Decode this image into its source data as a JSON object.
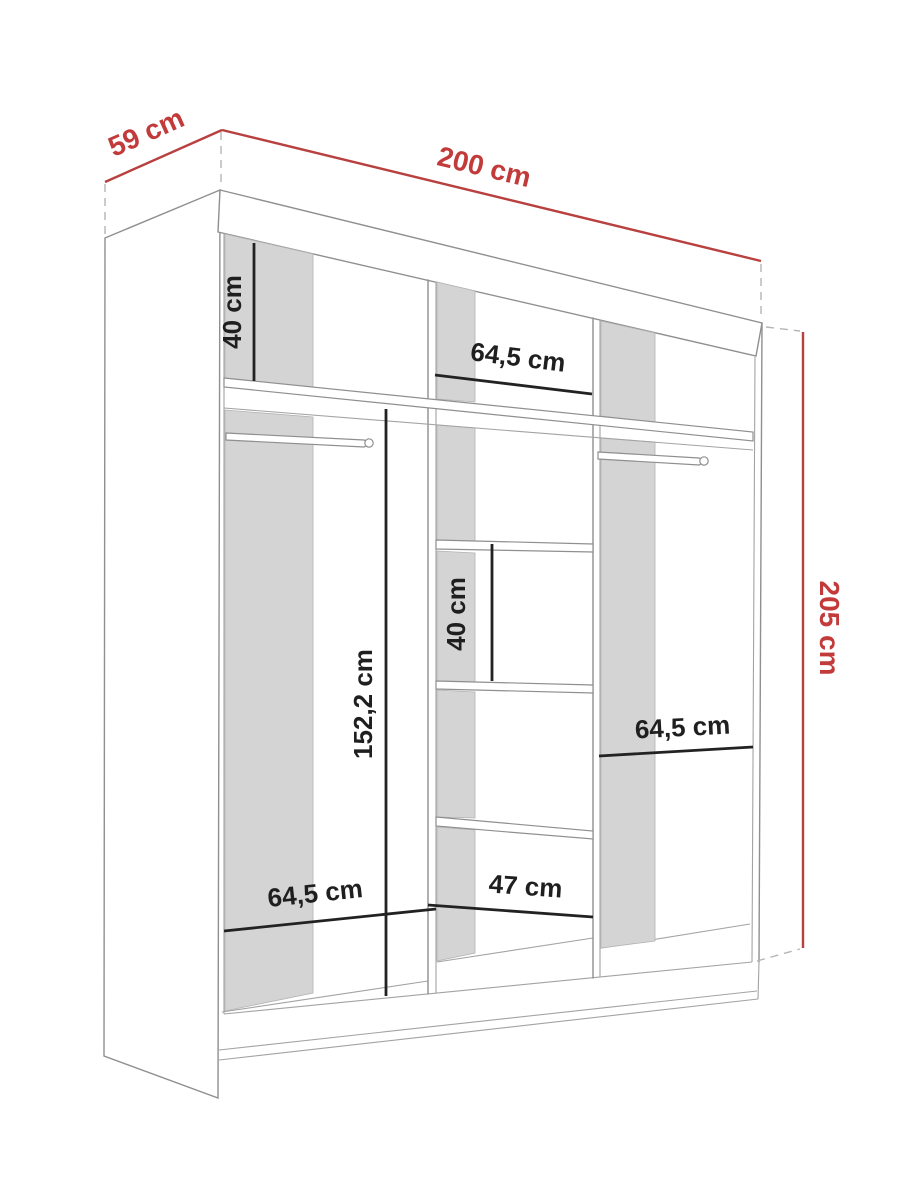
{
  "diagram": {
    "title": "Wardrobe dimension diagram",
    "unit": "cm",
    "colors": {
      "background": "#ffffff",
      "dimension_red": "#c23a3a",
      "dimension_red_line": "#b8403f",
      "dimension_black": "#1f1f1f",
      "panel_gray": "#d4d4d4",
      "outline_gray": "#8f8f8f"
    },
    "overall_dimensions": {
      "width": {
        "label": "200 cm"
      },
      "depth": {
        "label": "59 cm"
      },
      "height": {
        "label": "205 cm"
      }
    },
    "internal_dimensions": {
      "top_compartment_height": {
        "label": "40 cm"
      },
      "top_middle_width": {
        "label": "64,5 cm"
      },
      "left_hanging_height": {
        "label": "152,2 cm"
      },
      "middle_compartment_height": {
        "label": "40 cm"
      },
      "right_section_width": {
        "label": "64,5 cm"
      },
      "left_section_width": {
        "label": "64,5 cm"
      },
      "middle_section_width": {
        "label": "47 cm"
      }
    }
  }
}
